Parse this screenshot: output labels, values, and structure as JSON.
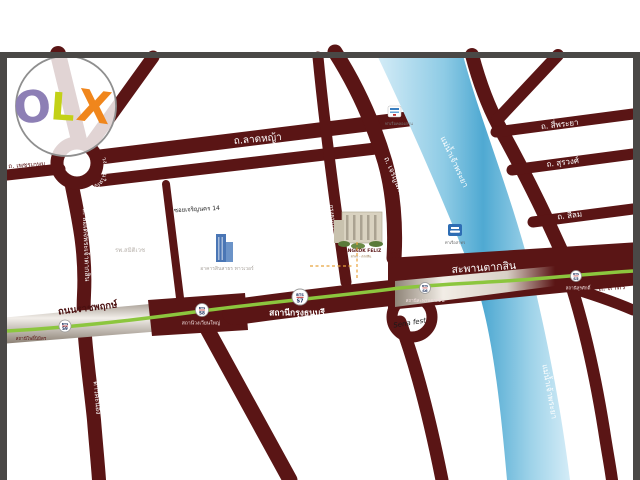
{
  "logo": {
    "o": "O",
    "l": "L",
    "x": "X"
  },
  "roads": {
    "phetkasem": "ถ. เพชรเกษม",
    "wongwianyai": "วงเวียนใหญ่",
    "latya": "ถ.ลาดหญ้า",
    "charoenrak": "ถ. เจริญรัก",
    "soi_charoennakhon14": "ซอยเจริญนคร 14",
    "somdet_taksin": "ถ. สมเด็จพระเจ้าตากสิน",
    "ratchaphruek": "ถนนราชพฤกษ์",
    "daokhanong": "ดาวคะนอง",
    "krungthonburi5": "กรุงธนบุรี 5",
    "charoennakhon": "ถ. เจริญนคร",
    "charoenkrung": "ถ. เจริญกรุง",
    "siphraya": "ถ. สี่พระยา",
    "surawong": "ถ. สุรวงศ์",
    "silom": "ถ. สีลม",
    "sathorn": "ถ. สาทร"
  },
  "river_label": "แม่น้ำเจ้าพระยา",
  "bridge_label": "สะพานตากสิน",
  "bts": {
    "badge": "BTS",
    "stations": [
      {
        "code": "S9",
        "label": "สถานีโพธิ์นิมิตร"
      },
      {
        "code": "S8",
        "label": "สถานีวงเวียนใหญ่"
      },
      {
        "code": "S7",
        "label": "สถานีกรุงธนบุรี"
      },
      {
        "code": "S6",
        "label": "สถานีสะพานตากสิน"
      },
      {
        "code": "S5",
        "label": "สถานีสุรศักดิ์"
      }
    ]
  },
  "landmarks": {
    "hospital": "รพ.สมิติเวช",
    "sinsathorn_tower": "อาคารสินสาธร ทาวเวอร์",
    "bangkok_feliz_name": "BANGKOK FELIZ",
    "bangkok_feliz_sub": "สาทร - ตากสิน",
    "sena_fest": "Sena fest",
    "pier_west": "ท่าเรือคลองสาน",
    "pier_east": "ท่าเรือสาทร"
  },
  "colors": {
    "road": "#5a1515",
    "river_light": "#c9e7f4",
    "river_mid": "#7cc4e0",
    "river_core": "#4fa9d2",
    "bts_green": "#8cc63e",
    "silver_road": "#efe9e2",
    "frame": "#4a4846",
    "logo_o": "#8d7fb5",
    "logo_l": "#c3d117",
    "logo_x": "#f0861c"
  }
}
